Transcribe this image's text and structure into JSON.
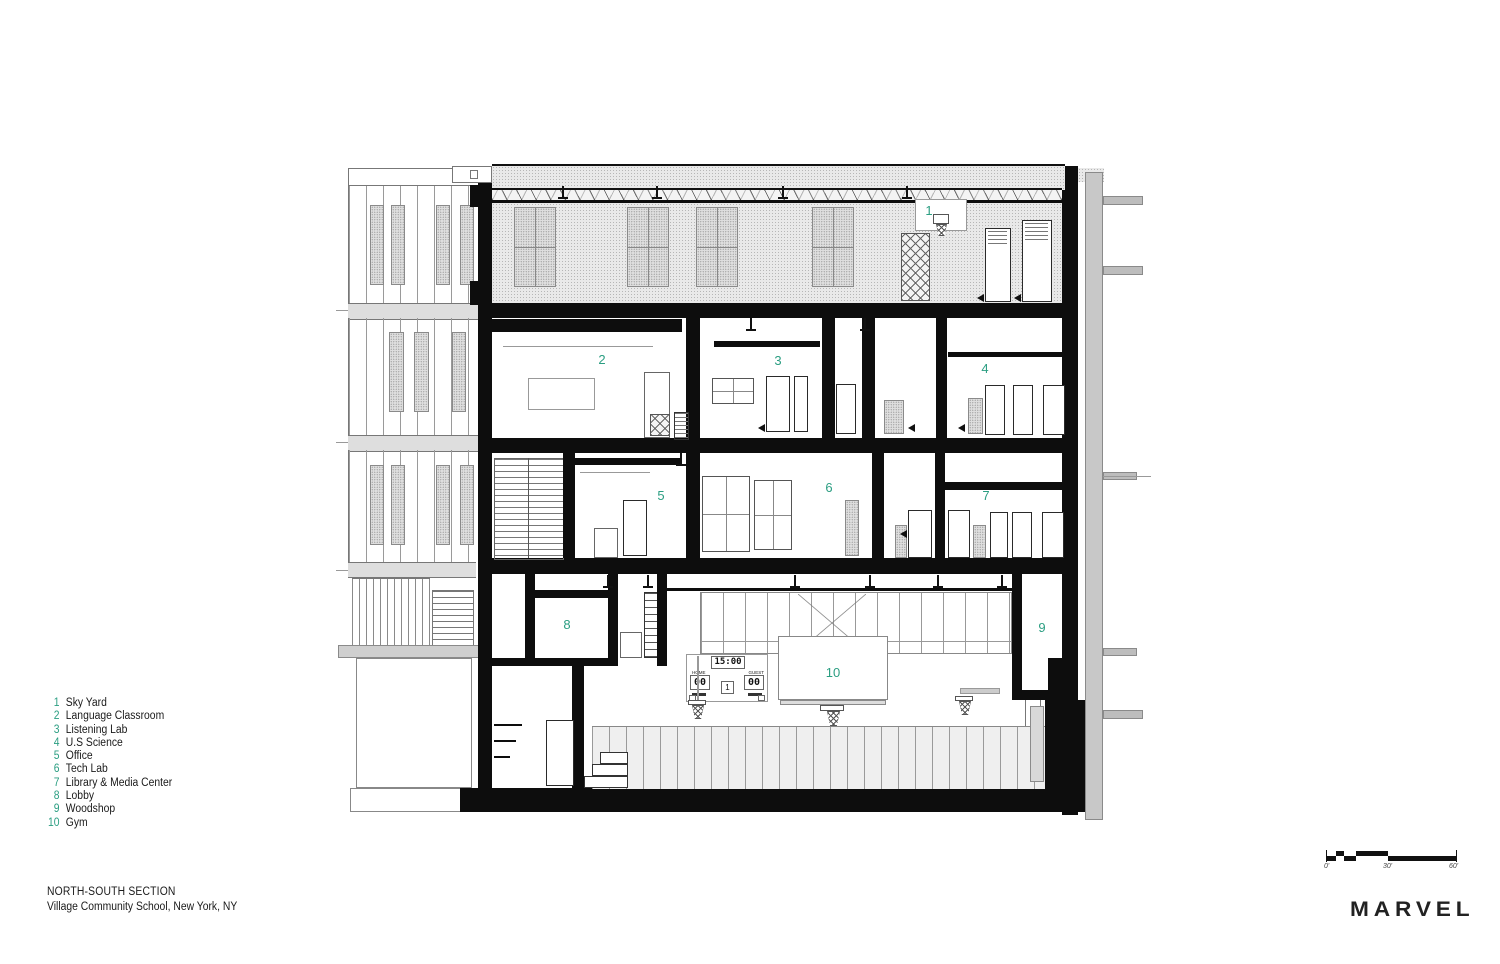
{
  "colors": {
    "accent": "#2b9e82",
    "ink": "#111111"
  },
  "legend": {
    "items": [
      {
        "num": "1",
        "label": "Sky Yard"
      },
      {
        "num": "2",
        "label": "Language Classroom"
      },
      {
        "num": "3",
        "label": "Listening Lab"
      },
      {
        "num": "4",
        "label": "U.S Science"
      },
      {
        "num": "5",
        "label": "Office"
      },
      {
        "num": "6",
        "label": "Tech Lab"
      },
      {
        "num": "7",
        "label": "Library & Media Center"
      },
      {
        "num": "8",
        "label": "Lobby"
      },
      {
        "num": "9",
        "label": "Woodshop"
      },
      {
        "num": "10",
        "label": "Gym"
      }
    ]
  },
  "room_numbers": [
    "1",
    "2",
    "3",
    "4",
    "5",
    "6",
    "7",
    "8",
    "9",
    "10"
  ],
  "scoreboard": {
    "clock": "15:00",
    "home_label": "HOME",
    "home_score": "00",
    "guest_label": "GUEST",
    "guest_score": "00",
    "period": "1"
  },
  "title_block": {
    "line1": "NORTH-SOUTH SECTION",
    "line2": "Village Community School, New York, NY"
  },
  "scale_bar": {
    "start": "0'",
    "mid": "30'",
    "end": "60'"
  },
  "logo": {
    "text": "MARVEL"
  }
}
